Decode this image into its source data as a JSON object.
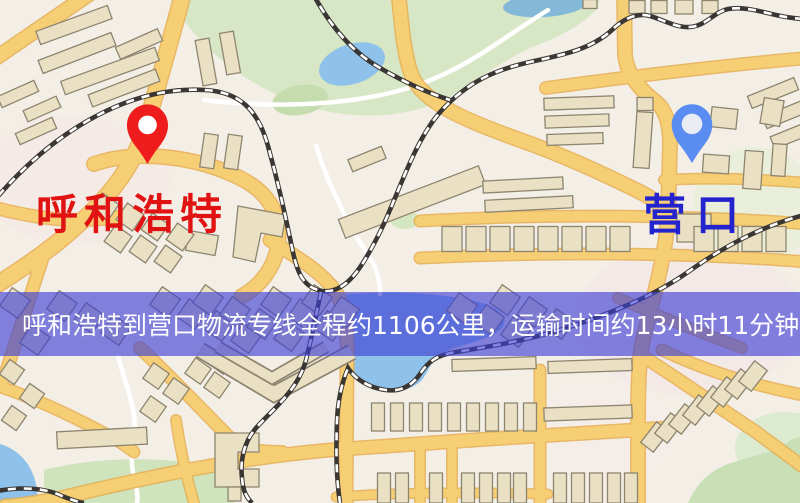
{
  "origin": {
    "name": "呼和浩特",
    "label_color": "#e01212",
    "pin_color": "#ee1c1c"
  },
  "destination": {
    "name": "营口",
    "label_color": "#2424cf",
    "pin_color": "#5b8cf2"
  },
  "banner": {
    "text": "呼和浩特到营口物流专线全程约1106公里，运输时间约13小时11分钟.",
    "distance_text": "1106公里",
    "duration_text": "13小时11分钟",
    "background": "rgba(60,62,212,0.63)",
    "text_color": "#ffffff"
  },
  "map_palette": {
    "background": "#f4efe6",
    "road": "#f6cf74",
    "road_casing": "#e7ae52",
    "minor_road": "#ffffff",
    "building": "#eae0c4",
    "building_outline": "#8d8570",
    "park": "#d7e7c5",
    "water": "#8fc2ea",
    "railway": "#3a3633"
  }
}
